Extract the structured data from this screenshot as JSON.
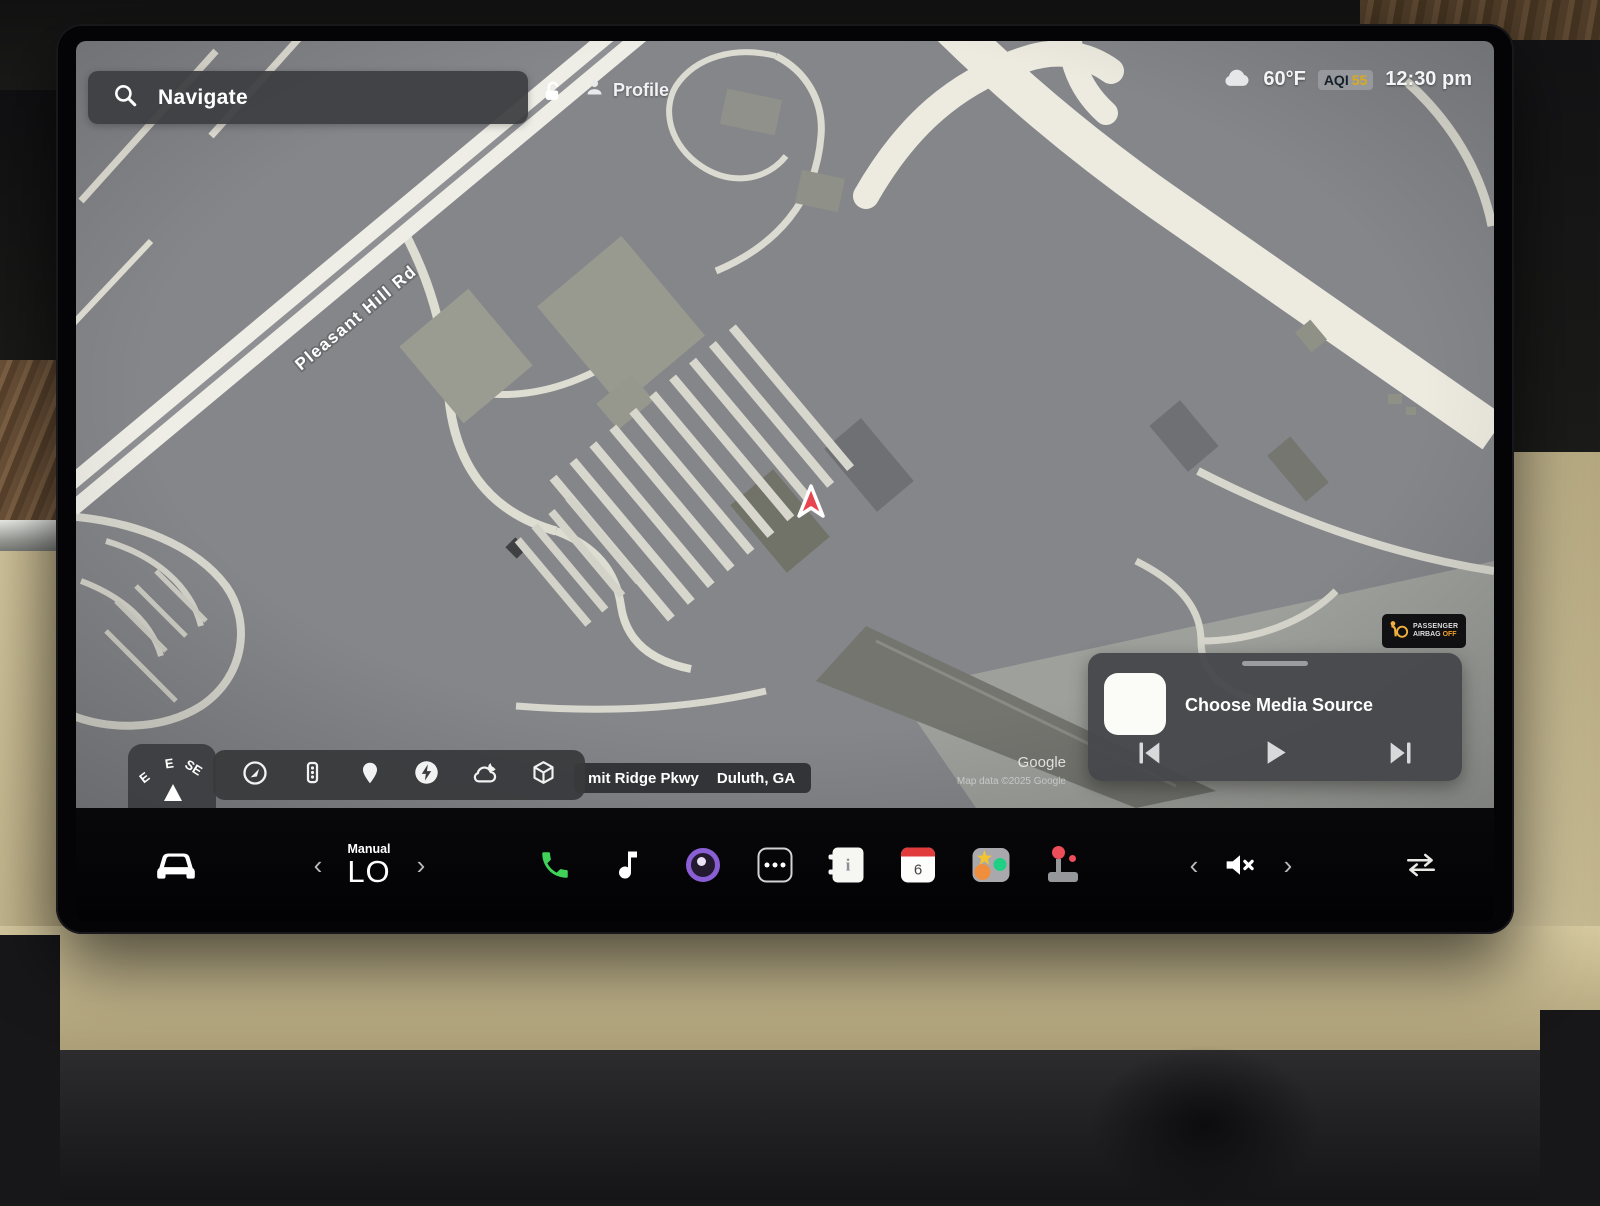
{
  "status_bar": {
    "search_label": "Navigate",
    "profile_label": "Profile",
    "temperature": "60°F",
    "aqi_label": "AQI",
    "aqi_value": "55",
    "time": "12:30 pm"
  },
  "map": {
    "road_label": "Pleasant Hill Rd",
    "address_street": "mit Ridge Pkwy",
    "address_city": "Duluth, GA",
    "attribution_source": "Google",
    "attribution_note": "Map data ©2025 Google",
    "compass_letters": [
      "E",
      "E",
      "SE"
    ],
    "control_icons": [
      "globe-icon",
      "traffic-light-icon",
      "location-pin-icon",
      "charging-icon",
      "weather-icon",
      "cube-3d-icon"
    ]
  },
  "airbag_badge": {
    "line1": "PASSENGER",
    "line2": "AIRBAG",
    "status": "OFF"
  },
  "media_panel": {
    "title": "Choose Media Source",
    "transport_icons": [
      "previous-track-icon",
      "play-icon",
      "next-track-icon"
    ]
  },
  "dock": {
    "climate_mode": "Manual",
    "climate_temp": "LO",
    "calendar_day": "6",
    "icons": [
      "car-icon",
      "phone-icon",
      "music-icon",
      "camera-icon",
      "more-apps-icon",
      "notes-icon",
      "calendar-icon",
      "toybox-icon",
      "arcade-icon",
      "mute-icon",
      "swap-arrows-icon"
    ]
  },
  "colors": {
    "phone_green": "#3fd158",
    "aqi_yellow": "#d8ab1e",
    "airbag_off_orange": "#f0a028",
    "marker_red": "#e84550",
    "camera_purple": "#8a5fd6"
  }
}
